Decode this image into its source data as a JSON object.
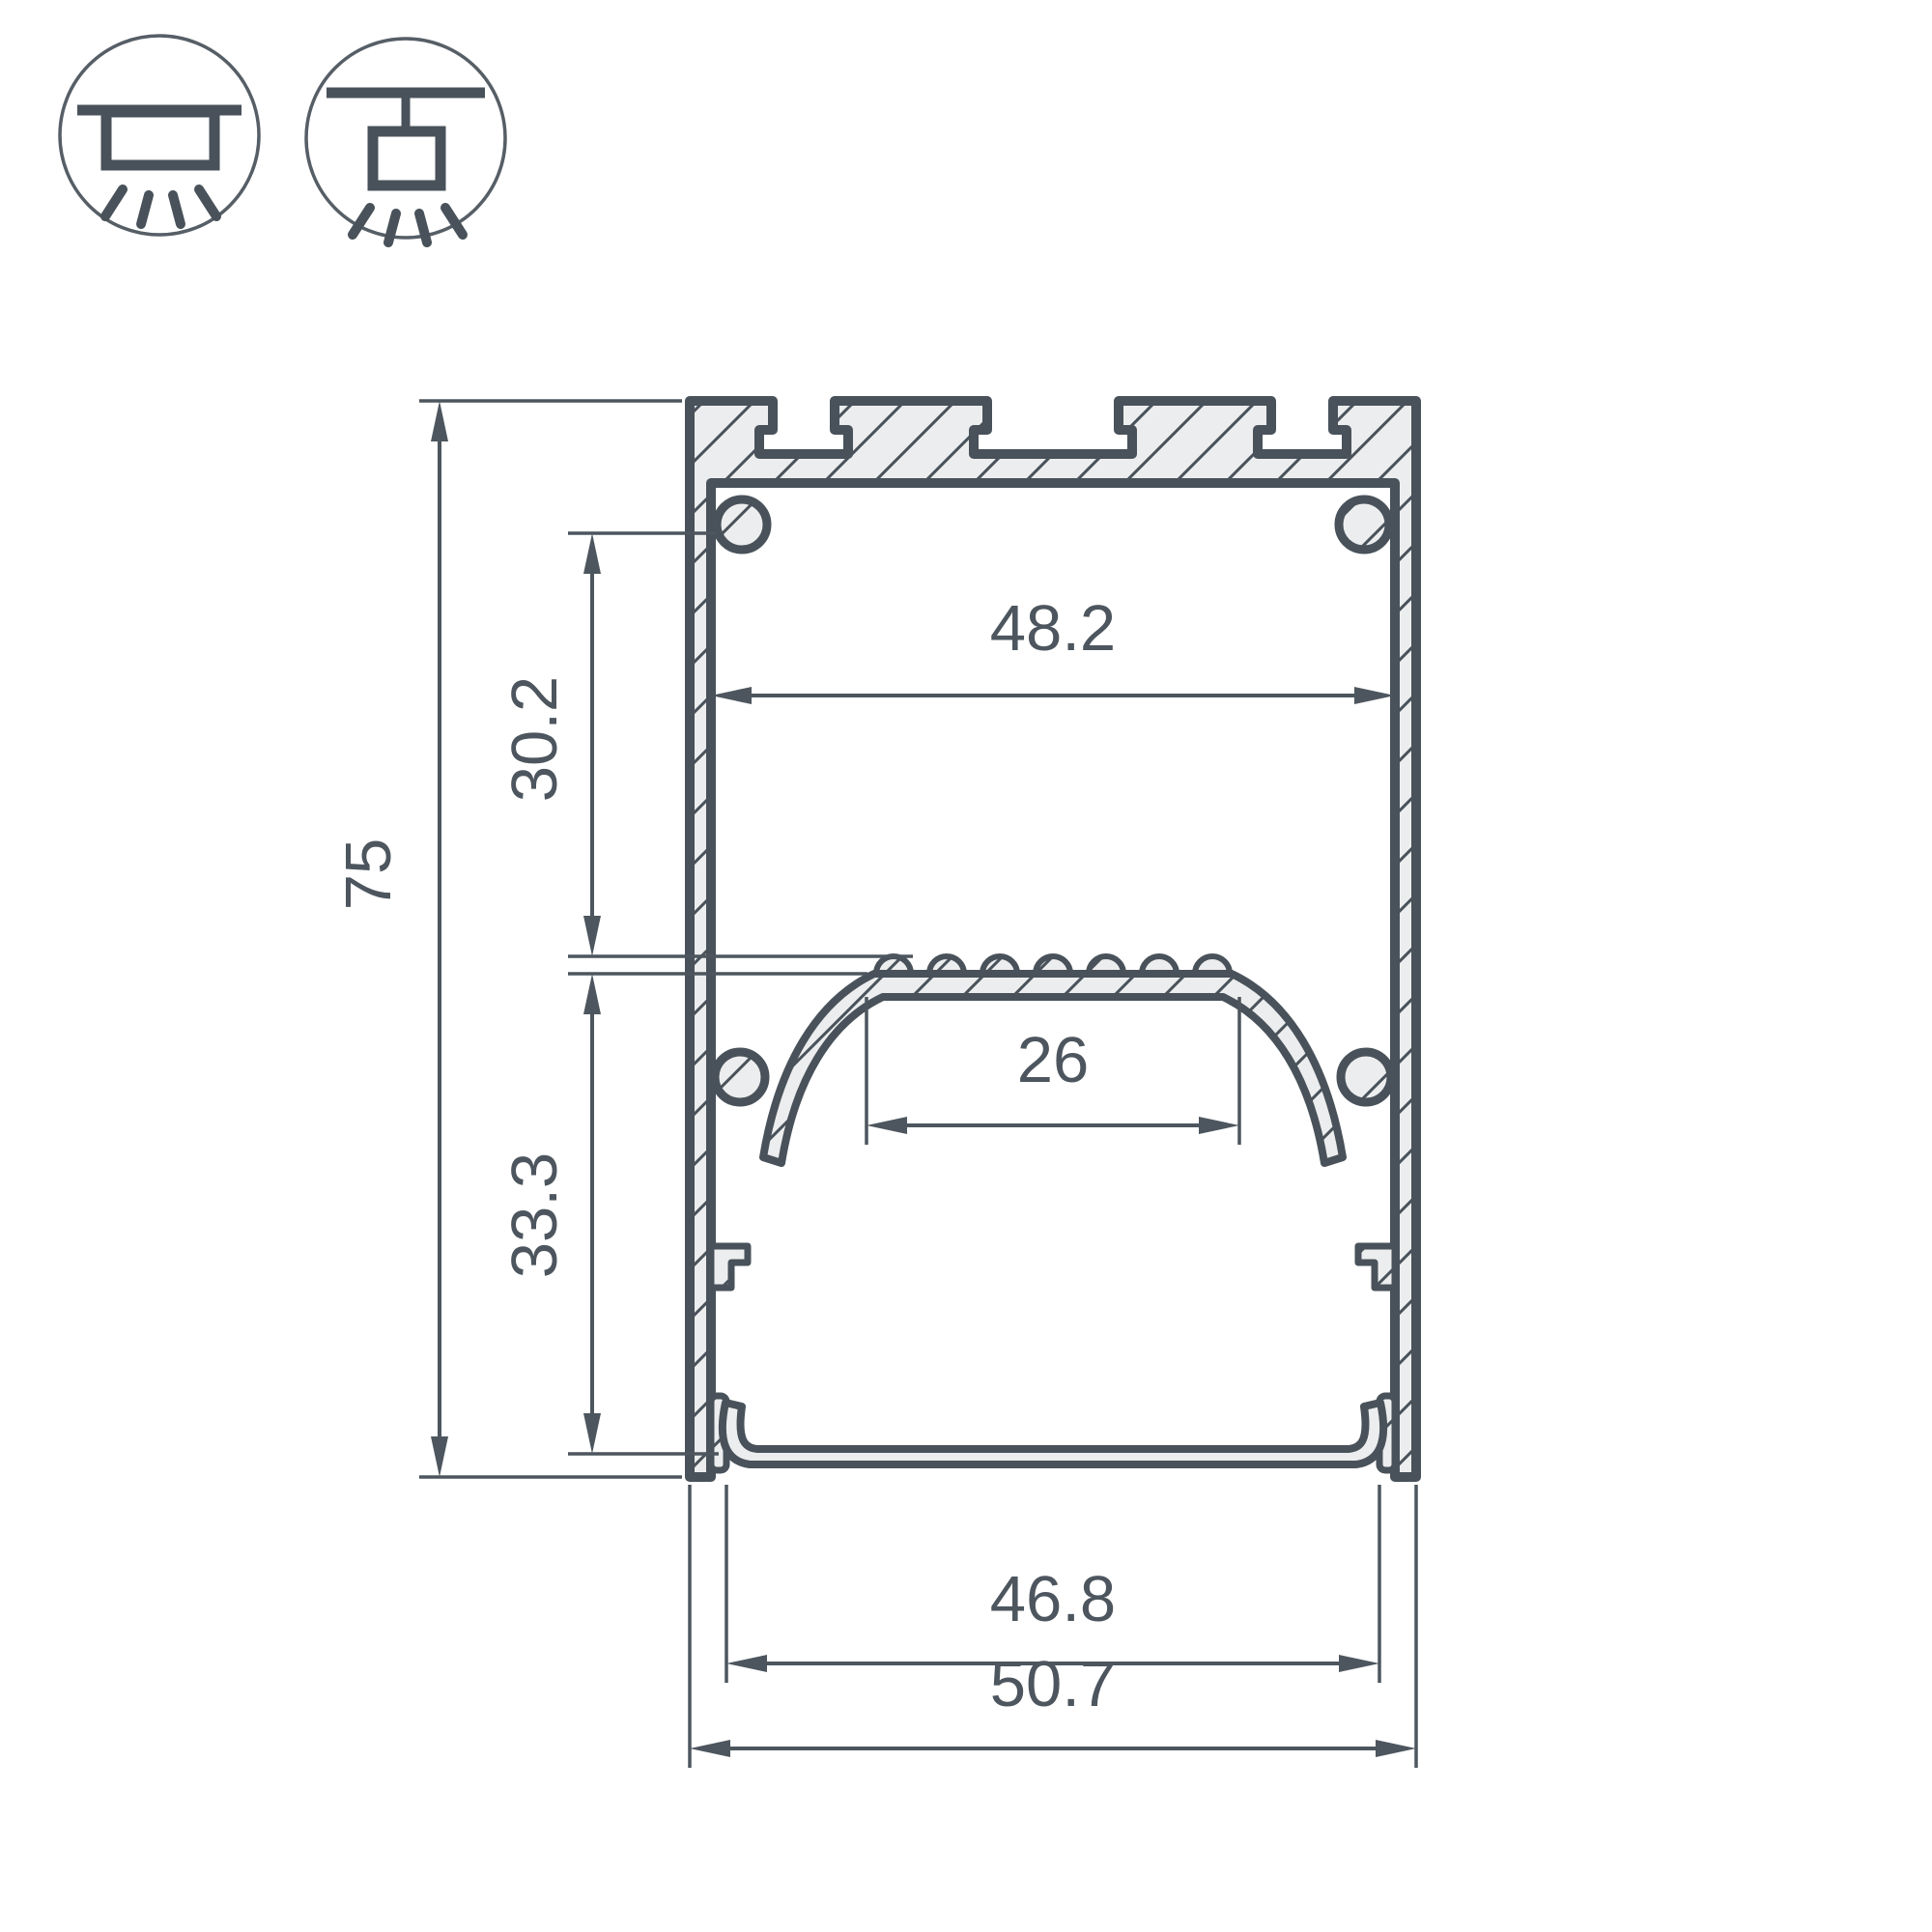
{
  "drawing": {
    "type": "profile-cross-section",
    "dims": {
      "overall_height": "75",
      "upper_cavity_height": "30.2",
      "lower_cavity_height": "33.3",
      "top_inner_width": "48.2",
      "led_platform_width": "26",
      "bottom_opening_width": "46.8",
      "overall_width": "50.7"
    }
  },
  "icons": {
    "surface_mount": "surface-mount-luminaire-icon",
    "pendant_mount": "suspended-luminaire-icon"
  },
  "colors": {
    "line": "#49525a",
    "dim_line": "#4d565e",
    "fill": "#ecedee",
    "background": "#ffffff"
  }
}
